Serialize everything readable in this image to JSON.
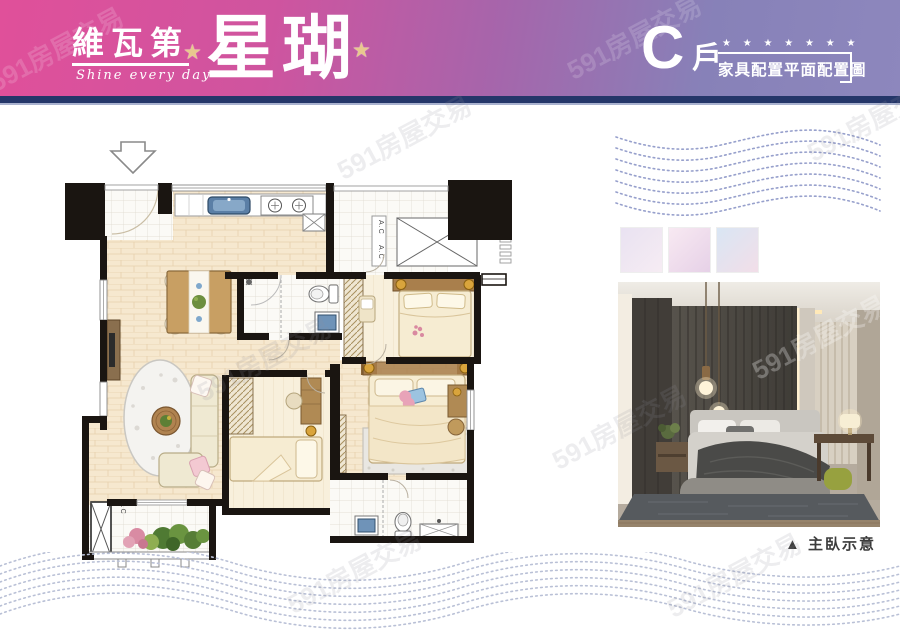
{
  "watermark": {
    "text": "591房屋交易"
  },
  "header": {
    "brand": "維瓦第",
    "tagline": "Shine every day",
    "title": "星瑚",
    "deco_star": "★",
    "unit_letter": "C",
    "unit_suffix": "戶",
    "stars_row": "★ ★ ★ ★ ★ ★ ★",
    "subtitle": "家具配置平面配置圖",
    "colors": {
      "gradient_left": "#e0509a",
      "gradient_right": "#8d87bd",
      "strip": "#243669"
    }
  },
  "floor_plan": {
    "ac_label": "A.C",
    "entry_marker": "entry-arrow"
  },
  "right_panel": {
    "caption": "▲ 主臥示意",
    "swatches": [
      {
        "name": "lavender",
        "from": "#e9e2f2",
        "to": "#f6ecf3"
      },
      {
        "name": "pink",
        "from": "#f8e9f2",
        "to": "#e6d1e7"
      },
      {
        "name": "blue-pink",
        "from": "#d9e6f4",
        "to": "#f2dee8"
      }
    ],
    "wave_dot_color": "#97a0cc"
  },
  "bottom_wave_color": "#b9c0d6"
}
